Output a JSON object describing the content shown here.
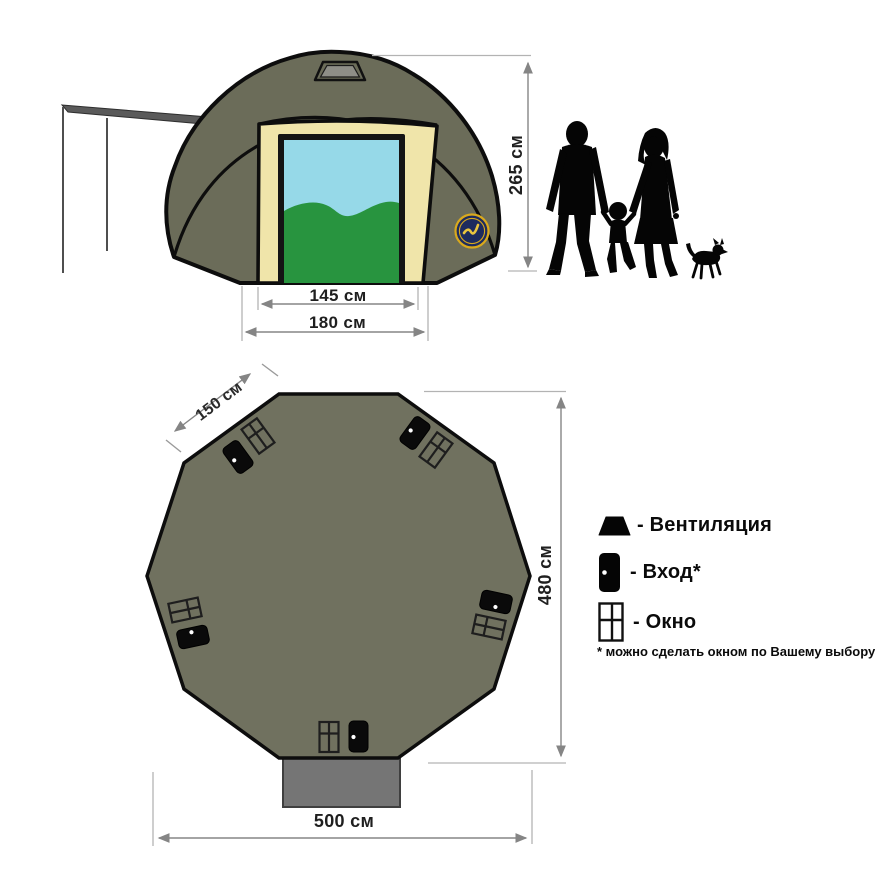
{
  "front_view": {
    "height_label": "265 см",
    "door_width_label": "145 см",
    "base_width_label": "180 см"
  },
  "floor_plan": {
    "side_label": "150 см",
    "depth_label": "480 см",
    "width_label": "500 см"
  },
  "legend": {
    "items": [
      {
        "icon": "vent-icon",
        "label": "- Вентиляция"
      },
      {
        "icon": "entrance-door-icon",
        "label": "- Вход*"
      },
      {
        "icon": "window-icon",
        "label": "- Окно"
      }
    ],
    "note": "* можно сделать окном по Вашему выбору"
  },
  "colors": {
    "tent_body": "#6b6c59",
    "front_panel": "#f0e5aa",
    "sky": "#96d9e8",
    "grass": "#28943f",
    "plan_floor": "#70715f",
    "vestibule": "#757575",
    "awning": "#5a5a5a",
    "vent_inner": "#8e8e87",
    "logo_navy": "#1d2b5e",
    "logo_gold": "#d9a91c",
    "dimension_line": "#858585",
    "extension_line": "#b3b3b3",
    "text": "#1f1f1f"
  }
}
